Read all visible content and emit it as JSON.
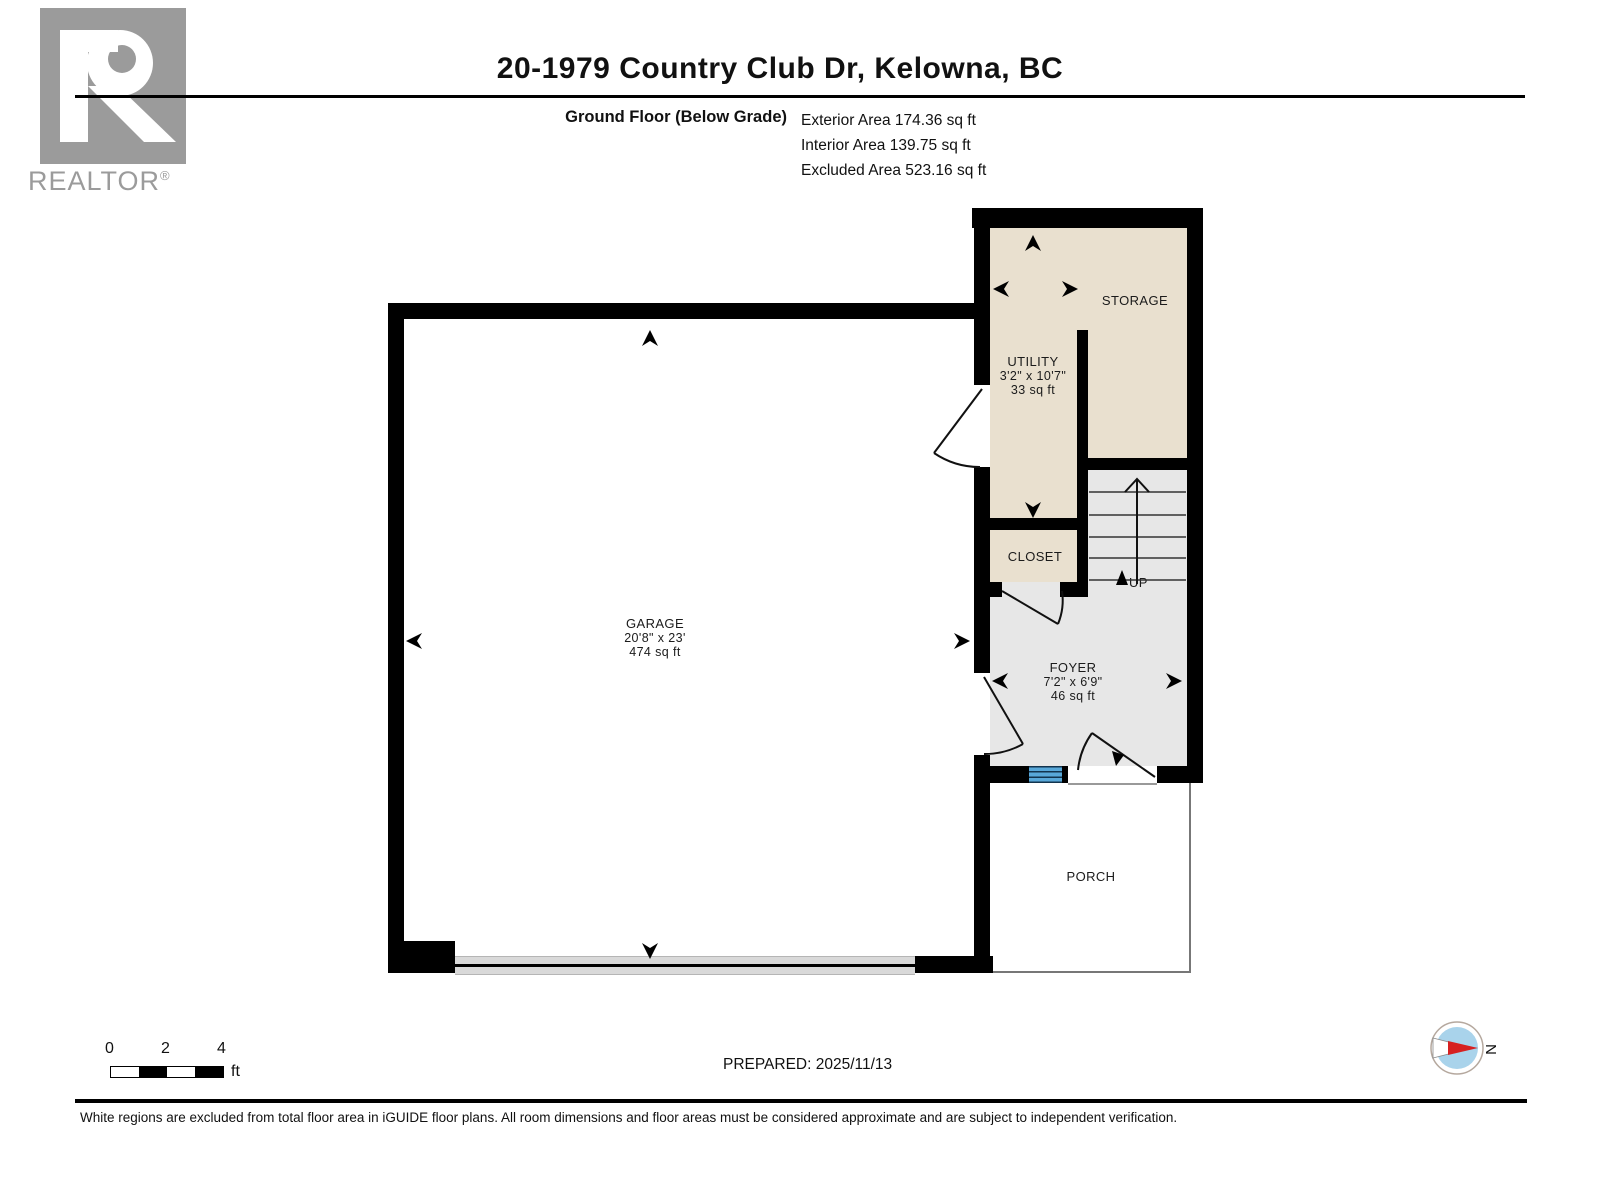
{
  "logo": {
    "brand": "REALTOR",
    "registered": "®"
  },
  "header": {
    "title": "20-1979 Country Club Dr, Kelowna, BC",
    "floor_label": "Ground Floor (Below Grade)",
    "stats": [
      "Exterior Area 174.36 sq ft",
      "Interior Area 139.75 sq ft",
      "Excluded Area 523.16 sq ft"
    ]
  },
  "rooms": {
    "garage": {
      "name": "GARAGE",
      "dims": "20'8\" x 23'",
      "area": "474 sq ft"
    },
    "utility": {
      "name": "UTILITY",
      "dims": "3'2\" x 10'7\"",
      "area": "33 sq ft"
    },
    "storage": {
      "name": "STORAGE"
    },
    "closet": {
      "name": "CLOSET"
    },
    "foyer": {
      "name": "FOYER",
      "dims": "7'2\" x 6'9\"",
      "area": "46 sq ft"
    },
    "porch": {
      "name": "PORCH"
    }
  },
  "stairs": {
    "up_label": "UP"
  },
  "scale_bar": {
    "ticks": [
      "0",
      "2",
      "4"
    ],
    "unit": "ft"
  },
  "compass": {
    "north_label": "N"
  },
  "footer": {
    "prepared": "PREPARED: 2025/11/13",
    "disclaimer": "White regions are excluded from total floor area in iGUIDE floor plans. All room dimensions and floor areas must be considered approximate and are subject to independent verification."
  },
  "colors": {
    "wall": "#000000",
    "included_room": "#e9e0cf",
    "circulation": "#e7e7e7",
    "excluded": "#ffffff",
    "entry_steps_blue": "#58a8d9",
    "logo_grey": "#9b9b9b",
    "compass_inner_blue": "#a9d3eb",
    "compass_needle_red": "#d62020"
  }
}
